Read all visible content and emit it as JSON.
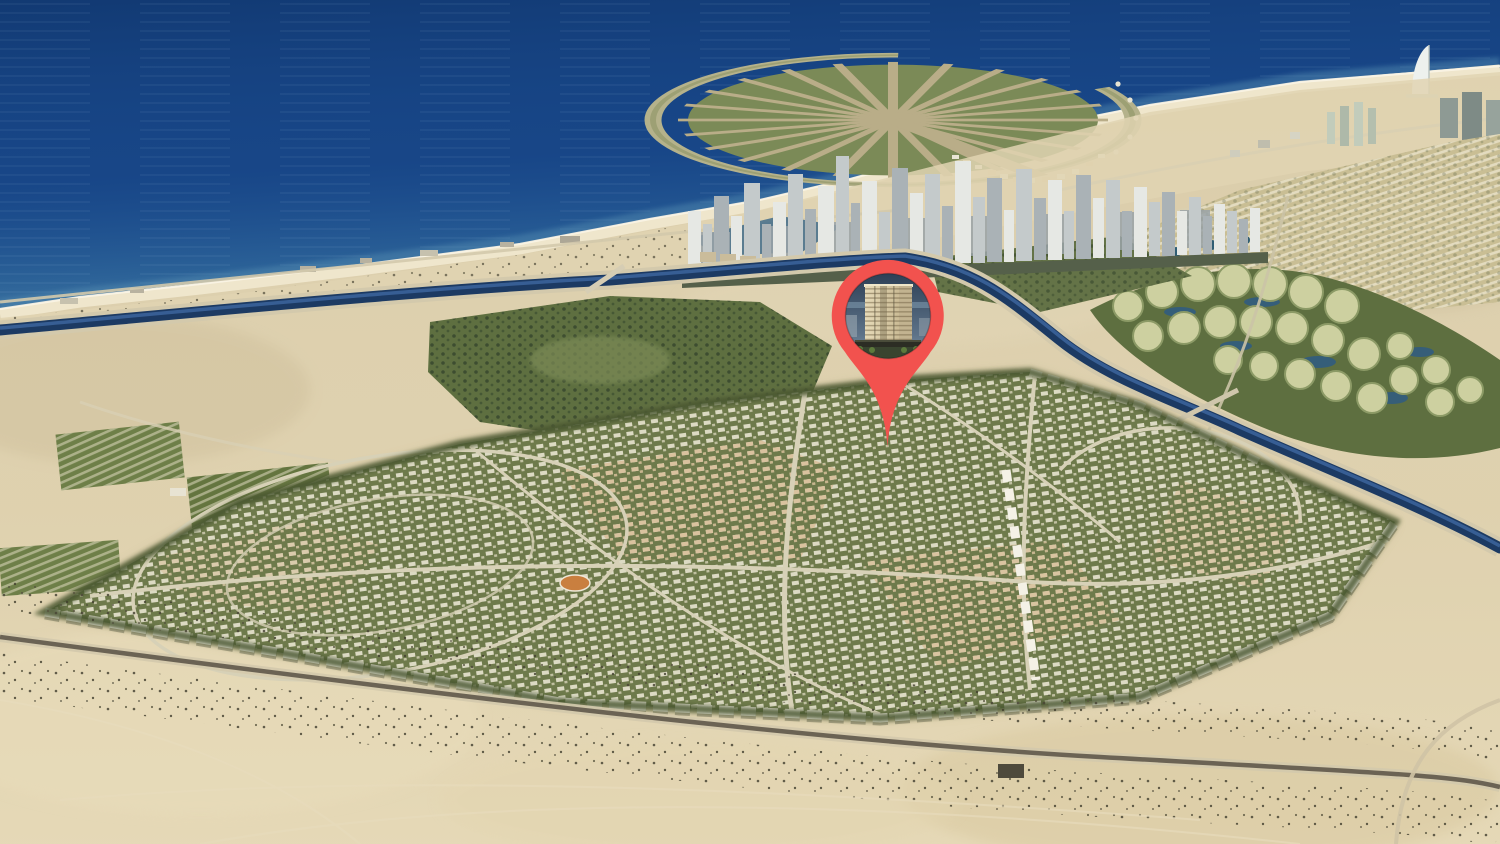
{
  "scene": {
    "type": "aerial-masterplan-render",
    "view": "coastal city aerial view with property location marker",
    "regions": [
      "sea",
      "palm-shaped-artificial-island",
      "sail-shaped-hotel",
      "city-tower-skyline",
      "coastal-beach",
      "coastal-canal",
      "island-cluster-community",
      "villa-rows-community",
      "golf-parkland",
      "orchard-farms",
      "master-planned-community",
      "perimeter-apartment-blocks",
      "sports-track",
      "desert-foreground",
      "desert-road",
      "location-marker"
    ]
  },
  "marker": {
    "shape": "map-pin",
    "color": "#F2524E",
    "window_content": "high-rise-tower-photo",
    "tower_facade": "#D9CCAA",
    "tower_sky": "#31455C"
  },
  "colors": {
    "sea_deep": "#16417F",
    "sea_shore": "#4F87AE",
    "sand": "#D7C9A6",
    "beach": "#EFE6CC",
    "canal": "#1C3A63",
    "community_green": "#6E7A4B",
    "parkland_green": "#5E6F40",
    "villa_khaki": "#C9BE94",
    "skyline_gray": "#C6CCCB",
    "road": "#D3C9AC",
    "asphalt": "#6B6354",
    "building_white": "#F1EDE0",
    "building_tan": "#D9C09A"
  }
}
